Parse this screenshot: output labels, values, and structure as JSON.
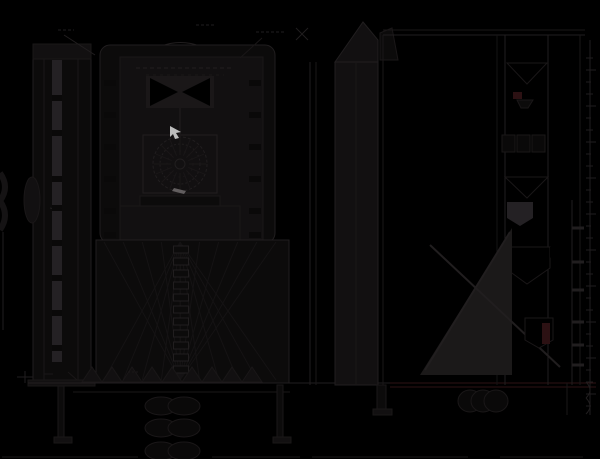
{
  "canvas": {
    "width": 600,
    "height": 459
  },
  "colors": {
    "background": "#000000",
    "line": "#211e1f",
    "line_soft": "#1a1718",
    "line_faint": "#151314",
    "panel": "#121011",
    "panel_dark": "#0c0b0b",
    "panel_light": "#242124",
    "wedge_light": "#1b1919",
    "fill_black": "#000000",
    "tick_dark": "#0a0909",
    "maroon": "#2c1113",
    "maroon_line": "#2e1214",
    "cursor": "#bcbcbc",
    "gray_mark": "#757172"
  },
  "cursor_marker": {
    "x": 170,
    "y": 126,
    "note": "small light arrow marker, only bright element"
  },
  "views": {
    "left_side_view": {
      "label": ""
    },
    "front_view": {
      "label": ""
    },
    "center_shaft_view": {
      "label": ""
    },
    "right_section_view": {
      "label": ""
    }
  },
  "generated": {
    "fans": [
      {
        "apex": [
          180,
          380
        ],
        "y": 242,
        "x_start": 104,
        "x_end": 276,
        "count": 10
      },
      {
        "apex": [
          180,
          242
        ],
        "y": 380,
        "x_start": 104,
        "x_end": 276,
        "count": 10
      }
    ],
    "teeth": {
      "y_base": 382,
      "y_apex": 367,
      "x_start": 82,
      "x_end": 278,
      "step": 20
    },
    "chain_column": {
      "x": 181,
      "y_start": 246,
      "y_end": 374,
      "step": 12,
      "w": 15,
      "h": 7
    },
    "chain_links": {
      "cx1": 161,
      "cx2": 184,
      "rx": 16,
      "ry": 9,
      "cys": [
        406,
        428,
        451
      ]
    },
    "bottom_blob_row": {
      "cxs": [
        470,
        483,
        496
      ],
      "cy": 401,
      "rx": 12,
      "ry": 11
    },
    "ladder_rungs": {
      "x1": 572,
      "x2": 584,
      "ys": [
        228,
        262,
        290,
        322,
        345,
        365
      ]
    },
    "tick_columns": [
      {
        "x": 52,
        "w": 10,
        "h": 6,
        "ys": [
          95,
          130,
          176,
          205,
          240,
          275,
          310,
          345
        ]
      },
      {
        "x": 104,
        "w": 12,
        "h": 6,
        "ys": [
          80,
          112,
          144,
          176,
          208,
          232
        ]
      },
      {
        "x": 249,
        "w": 12,
        "h": 6,
        "ys": [
          80,
          112,
          144,
          176,
          208,
          232
        ]
      }
    ],
    "right_text_marks": {
      "x": 586,
      "y_start": 58,
      "y_end": 408,
      "step": 12,
      "widths": [
        7,
        10,
        5
      ]
    },
    "gear_radial": {
      "cx": 180,
      "cy": 164,
      "r1": 9,
      "r2": 26,
      "count": 16
    },
    "bottom_dim_segments": [
      [
        2,
        138
      ],
      [
        212,
        300
      ],
      [
        312,
        468
      ],
      [
        500,
        583
      ]
    ],
    "bottom_dim_y": 457
  }
}
